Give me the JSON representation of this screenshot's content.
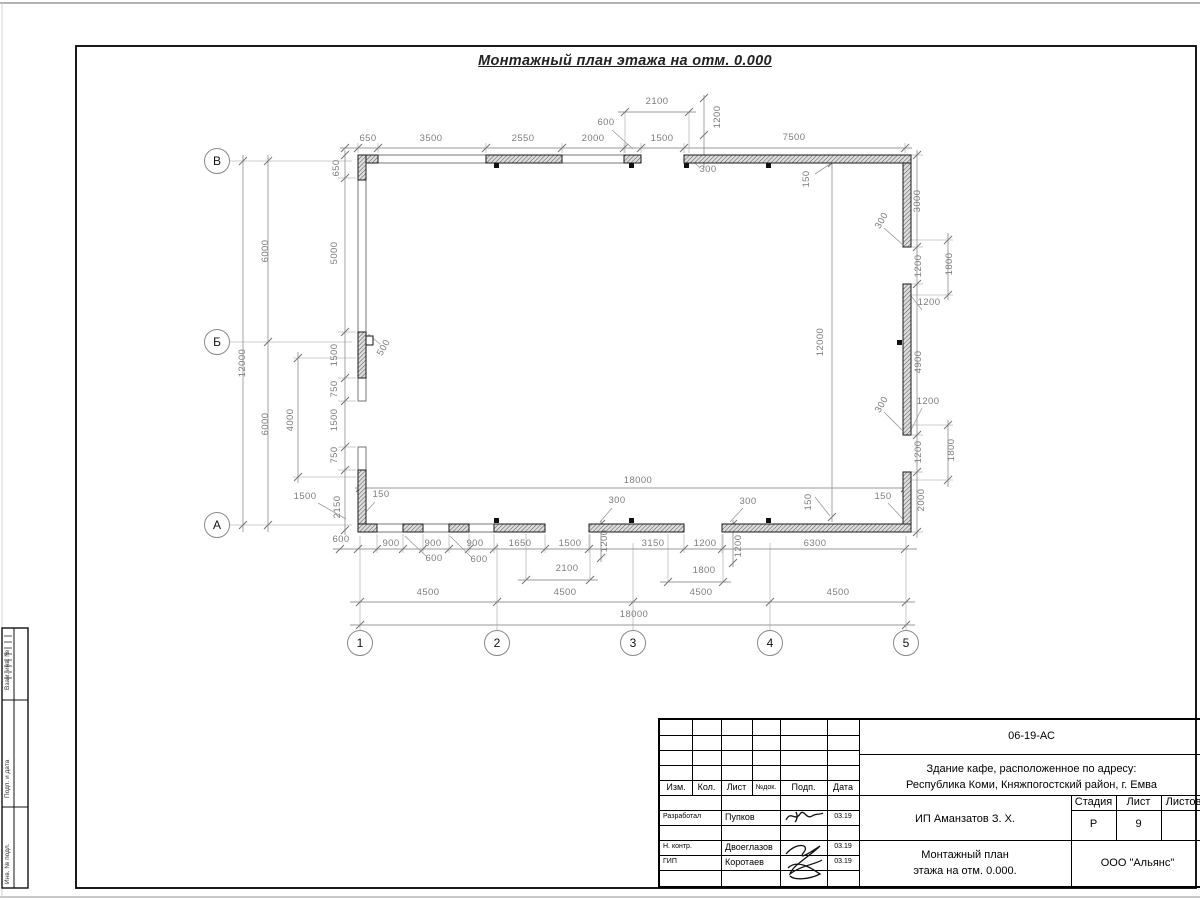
{
  "page": {
    "title": "Монтажный план этажа на отм. 0.000"
  },
  "axes": {
    "vertical": [
      {
        "label": "В",
        "x": 217,
        "y": 161
      },
      {
        "label": "Б",
        "x": 217,
        "y": 342
      },
      {
        "label": "А",
        "x": 217,
        "y": 525
      }
    ],
    "horizontal": [
      {
        "label": "1",
        "x": 360,
        "y": 643
      },
      {
        "label": "2",
        "x": 497,
        "y": 643
      },
      {
        "label": "3",
        "x": 633,
        "y": 643
      },
      {
        "label": "4",
        "x": 770,
        "y": 643
      },
      {
        "label": "5",
        "x": 906,
        "y": 643
      }
    ]
  },
  "dim_labels": [
    {
      "t": "2100",
      "x": 657,
      "y": 104,
      "r": 0
    },
    {
      "t": "600",
      "x": 606,
      "y": 125,
      "r": 0
    },
    {
      "t": "1200",
      "x": 720,
      "y": 117,
      "r": -90
    },
    {
      "t": "650",
      "x": 368,
      "y": 141,
      "r": 0
    },
    {
      "t": "3500",
      "x": 431,
      "y": 141,
      "r": 0
    },
    {
      "t": "2550",
      "x": 523,
      "y": 141,
      "r": 0
    },
    {
      "t": "2000",
      "x": 593,
      "y": 141,
      "r": 0
    },
    {
      "t": "1500",
      "x": 662,
      "y": 141,
      "r": 0
    },
    {
      "t": "7500",
      "x": 794,
      "y": 140,
      "r": 0
    },
    {
      "t": "650",
      "x": 339,
      "y": 168,
      "r": -90
    },
    {
      "t": "300",
      "x": 708,
      "y": 172,
      "r": 0
    },
    {
      "t": "150",
      "x": 809,
      "y": 179,
      "r": -90
    },
    {
      "t": "3000",
      "x": 920,
      "y": 201,
      "r": -90
    },
    {
      "t": "300",
      "x": 884,
      "y": 222,
      "r": -60
    },
    {
      "t": "1200",
      "x": 921,
      "y": 266,
      "r": -90
    },
    {
      "t": "1800",
      "x": 952,
      "y": 264,
      "r": -90
    },
    {
      "t": "1200",
      "x": 929,
      "y": 305,
      "r": 0
    },
    {
      "t": "4900",
      "x": 921,
      "y": 362,
      "r": -90
    },
    {
      "t": "1200",
      "x": 928,
      "y": 404,
      "r": 0
    },
    {
      "t": "300",
      "x": 884,
      "y": 406,
      "r": -60
    },
    {
      "t": "1200",
      "x": 921,
      "y": 452,
      "r": -90
    },
    {
      "t": "1800",
      "x": 954,
      "y": 450,
      "r": -90
    },
    {
      "t": "150",
      "x": 883,
      "y": 499,
      "r": 0
    },
    {
      "t": "2000",
      "x": 924,
      "y": 500,
      "r": -90
    },
    {
      "t": "12000",
      "x": 823,
      "y": 342,
      "r": -90
    },
    {
      "t": "150",
      "x": 811,
      "y": 502,
      "r": -90
    },
    {
      "t": "18000",
      "x": 638,
      "y": 483,
      "r": 0
    },
    {
      "t": "12000",
      "x": 245,
      "y": 363,
      "r": -90
    },
    {
      "t": "6000",
      "x": 268,
      "y": 251,
      "r": -90
    },
    {
      "t": "6000",
      "x": 268,
      "y": 424,
      "r": -90
    },
    {
      "t": "5000",
      "x": 337,
      "y": 253,
      "r": -90
    },
    {
      "t": "1500",
      "x": 337,
      "y": 355,
      "r": -90
    },
    {
      "t": "750",
      "x": 337,
      "y": 389,
      "r": -90
    },
    {
      "t": "1500",
      "x": 337,
      "y": 420,
      "r": -90
    },
    {
      "t": "750",
      "x": 337,
      "y": 455,
      "r": -90
    },
    {
      "t": "2150",
      "x": 340,
      "y": 507,
      "r": -90
    },
    {
      "t": "4000",
      "x": 293,
      "y": 420,
      "r": -90
    },
    {
      "t": "500",
      "x": 386,
      "y": 349,
      "r": -60
    },
    {
      "t": "1500",
      "x": 305,
      "y": 499,
      "r": 0
    },
    {
      "t": "150",
      "x": 381,
      "y": 497,
      "r": 0
    },
    {
      "t": "600",
      "x": 341,
      "y": 542,
      "r": 0
    },
    {
      "t": "900",
      "x": 391,
      "y": 546,
      "r": 0
    },
    {
      "t": "900",
      "x": 433,
      "y": 546,
      "r": 0
    },
    {
      "t": "900",
      "x": 475,
      "y": 546,
      "r": 0
    },
    {
      "t": "1650",
      "x": 520,
      "y": 546,
      "r": 0
    },
    {
      "t": "1500",
      "x": 570,
      "y": 546,
      "r": 0
    },
    {
      "t": "3150",
      "x": 653,
      "y": 546,
      "r": 0
    },
    {
      "t": "1200",
      "x": 705,
      "y": 546,
      "r": 0
    },
    {
      "t": "6300",
      "x": 815,
      "y": 546,
      "r": 0
    },
    {
      "t": "600",
      "x": 434,
      "y": 561,
      "r": 0
    },
    {
      "t": "600",
      "x": 479,
      "y": 562,
      "r": 0
    },
    {
      "t": "1200",
      "x": 607,
      "y": 541,
      "r": -90
    },
    {
      "t": "1200",
      "x": 741,
      "y": 546,
      "r": -90
    },
    {
      "t": "300",
      "x": 617,
      "y": 503,
      "r": 0
    },
    {
      "t": "300",
      "x": 748,
      "y": 504,
      "r": 0
    },
    {
      "t": "2100",
      "x": 567,
      "y": 571,
      "r": 0
    },
    {
      "t": "1800",
      "x": 704,
      "y": 573,
      "r": 0
    },
    {
      "t": "4500",
      "x": 428,
      "y": 595,
      "r": 0
    },
    {
      "t": "4500",
      "x": 565,
      "y": 595,
      "r": 0
    },
    {
      "t": "4500",
      "x": 701,
      "y": 595,
      "r": 0
    },
    {
      "t": "4500",
      "x": 838,
      "y": 595,
      "r": 0
    },
    {
      "t": "18000",
      "x": 634,
      "y": 617,
      "r": 0
    }
  ],
  "title_block": {
    "doc_number": "06-19-АС",
    "project_line1": "Здание кафе, расположенное по адресу:",
    "project_line2": "Республика Коми, Княжпогостский район, г. Емва",
    "client": "ИП Аманзатов З. Х.",
    "sheet_title_line1": "Монтажный план",
    "sheet_title_line2": "этажа на отм. 0.000.",
    "company": "ООО \"Альянс\"",
    "header_cols": [
      "Изм.",
      "Кол.",
      "Лист",
      "№док.",
      "Подп.",
      "Дата"
    ],
    "stage_header": [
      "Стадия",
      "Лист",
      "Листов"
    ],
    "stage": "Р",
    "sheet_number": "9",
    "roles": [
      {
        "role": "Разработал",
        "name": "Пупков",
        "date": "03.19"
      },
      {
        "role": "Н. контр.",
        "name": "Двоеглазов",
        "date": "03.19"
      },
      {
        "role": "ГИП",
        "name": "Коротаев",
        "date": "03.19"
      }
    ]
  },
  "side_strip": [
    "Взам. инв. №",
    "Подп. и дата",
    "Инв. № подл."
  ]
}
